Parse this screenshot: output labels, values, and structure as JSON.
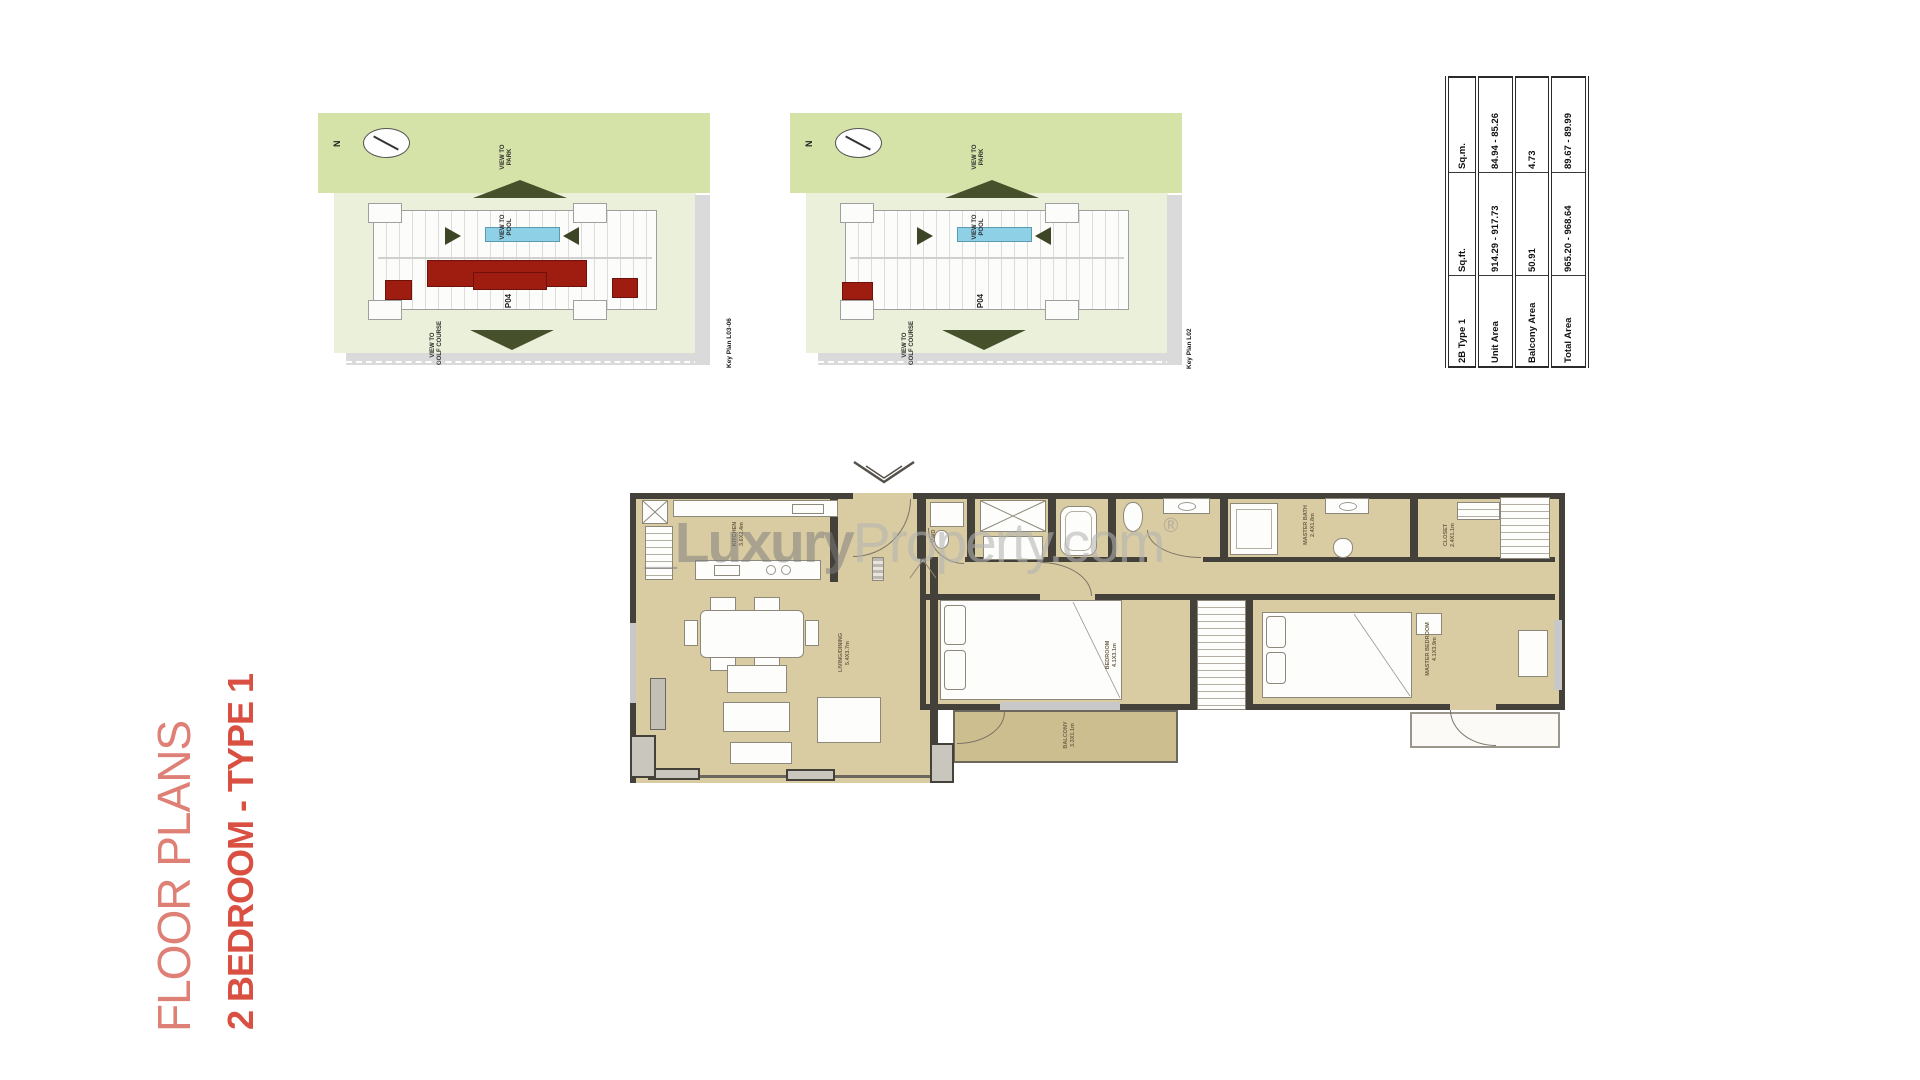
{
  "page": {
    "title_line1": "FLOOR PLANS",
    "title_line2": "2 BEDROOM - TYPE 1"
  },
  "watermark": {
    "name_bold": "_Luxury",
    "name_light": "Property.com",
    "registered": "®"
  },
  "key_plans": [
    {
      "north": "N",
      "park_line1": "VIEW TO",
      "park_line2": "PARK",
      "pool_line1": "VIEW TO",
      "pool_line2": "POOL",
      "golf_line1": "VIEW TO",
      "golf_line2": "GOLF COURSE",
      "building": "P04",
      "caption": "Key Plan L03-06"
    },
    {
      "north": "N",
      "park_line1": "VIEW TO",
      "park_line2": "PARK",
      "pool_line1": "VIEW TO",
      "pool_line2": "POOL",
      "golf_line1": "VIEW TO",
      "golf_line2": "GOLF COURSE",
      "building": "P04",
      "caption": "Key Plan L02"
    }
  ],
  "area_table": {
    "rows": [
      [
        "2B Type 1",
        "Sq.ft.",
        "Sq.m."
      ],
      [
        "Unit Area",
        "914.29 - 917.73",
        "84.94 - 85.26"
      ],
      [
        "Balcony Area",
        "50.91",
        "4.73"
      ],
      [
        "Total Area",
        "965.20 - 968.64",
        "89.67 - 89.99"
      ]
    ]
  },
  "floor_plan": {
    "labels": {
      "kitchen": "KITCHEN",
      "kitchen_dim": "3.6X2.4m",
      "living": "LIVING/DINING",
      "living_dim": "5.4X3.7m",
      "bedroom": "BEDROOM",
      "bedroom_dim": "4.1X3.1m",
      "master_bedroom": "MASTER BEDROOM",
      "master_bedroom_dim": "4.1X3.9m",
      "master_bath": "MASTER BATH",
      "master_bath_dim": "2.4X1.8m",
      "closet": "CLOSET",
      "closet_dim": "2.4X1.1m",
      "balcony": "BALCONY",
      "balcony_dim": "3.3X1.1m",
      "powder": "PWD"
    }
  },
  "colors": {
    "title_red": "#d94f41",
    "title_red_light": "#df8076",
    "unit_highlight_red": "#9e1c10",
    "pool_blue": "#8ed0e6",
    "park_green": "#d6e3a8",
    "floor_tan": "#d9cba2"
  }
}
